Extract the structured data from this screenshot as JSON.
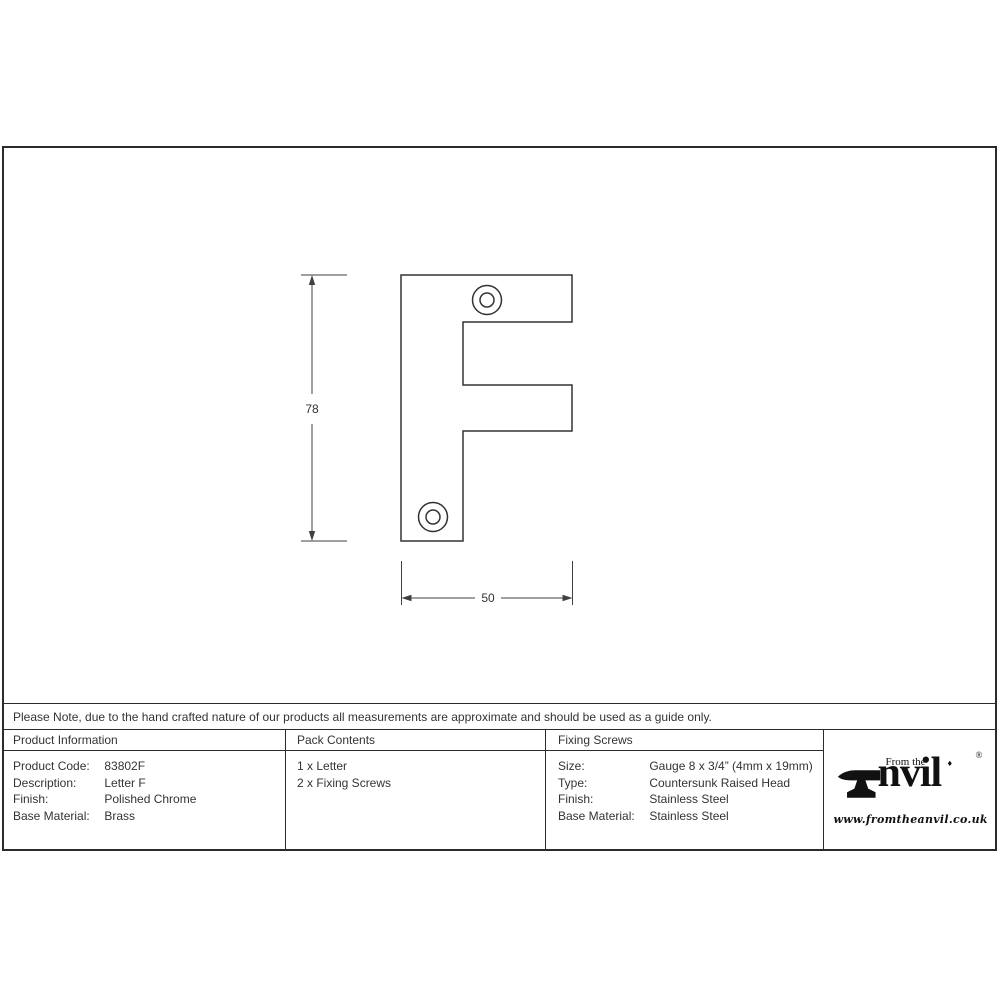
{
  "note": "Please Note, due to the hand crafted nature of our products all measurements are approximate and should be used as a guide only.",
  "drawing": {
    "height_label": "78",
    "width_label": "50"
  },
  "table": {
    "product_information": {
      "header": "Product Information",
      "rows": [
        {
          "label": "Product Code:",
          "value": "83802F"
        },
        {
          "label": "Description:",
          "value": "Letter F"
        },
        {
          "label": "Finish:",
          "value": "Polished Chrome"
        },
        {
          "label": "Base Material:",
          "value": "Brass"
        }
      ]
    },
    "pack_contents": {
      "header": "Pack Contents",
      "items": [
        "1 x Letter",
        "2 x Fixing Screws"
      ]
    },
    "fixing_screws": {
      "header": "Fixing Screws",
      "rows": [
        {
          "label": "Size:",
          "value": "Gauge 8 x 3/4” (4mm x 19mm)"
        },
        {
          "label": "Type:",
          "value": "Countersunk Raised Head"
        },
        {
          "label": "Finish:",
          "value": "Stainless Steel"
        },
        {
          "label": "Base Material:",
          "value": "Stainless Steel"
        }
      ]
    }
  },
  "logo": {
    "prefix": "From the",
    "diamond": "♦",
    "brand": "nvil",
    "registered": "®",
    "url": "www.fromtheanvil.co.uk"
  },
  "colors": {
    "line": "#2b2b2b",
    "drawing_line": "#404040",
    "text": "#333333",
    "background": "#ffffff"
  }
}
